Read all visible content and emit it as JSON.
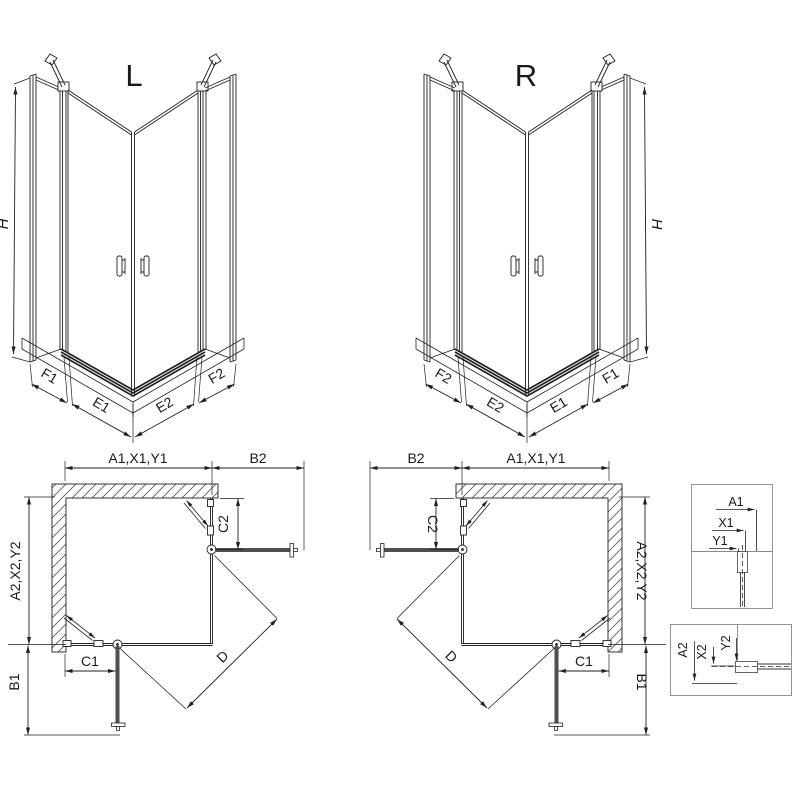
{
  "colors": {
    "line": "#222222",
    "wall_stroke": "#333333",
    "panel_dark": "#4f4f4f",
    "box_border": "#8a8a8a",
    "background": "#ffffff"
  },
  "iso_left": {
    "title": "L",
    "height_dim": "H",
    "bottom_dims": [
      "F1",
      "E1",
      "E2",
      "F2"
    ]
  },
  "iso_right": {
    "title": "R",
    "height_dim": "H",
    "bottom_dims": [
      "F2",
      "E2",
      "E1",
      "F1"
    ]
  },
  "plan_left": {
    "top_width_dim": "A1,X1,Y1",
    "door_open_dim_right": "B2",
    "side_depth_dim": "A2,X2,Y2",
    "fixed_part_dim_right": "C2",
    "fixed_part_dim_bottom": "C1",
    "door_open_dim_bottom": "B1",
    "entry_diag_dim": "D"
  },
  "plan_right": {
    "top_width_dim": "A1,X1,Y1",
    "door_open_dim_left": "B2",
    "side_depth_dim": "A2,X2,Y2",
    "fixed_part_dim_left": "C2",
    "fixed_part_dim_bottom": "C1",
    "door_open_dim_bottom": "B1",
    "entry_diag_dim": "D"
  },
  "detail_top": {
    "dims": [
      "A1",
      "X1",
      "Y1"
    ]
  },
  "detail_bottom": {
    "dims": [
      "A2",
      "X2",
      "Y2"
    ]
  }
}
